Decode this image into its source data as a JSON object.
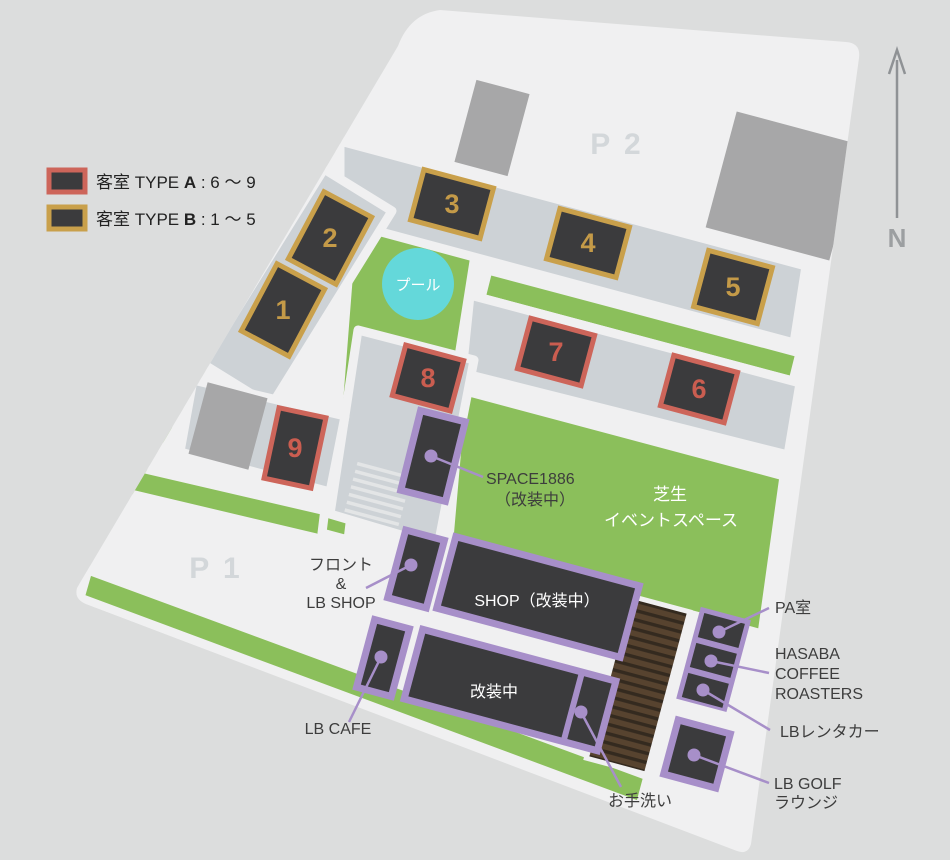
{
  "legend": {
    "items": [
      {
        "prefix": "客室 TYPE ",
        "letter": "A",
        "range": " : 6 ～ 9",
        "color": "#cd655a"
      },
      {
        "prefix": "客室 TYPE ",
        "letter": "B",
        "range": " : 1 ～ 5",
        "color": "#c9a04b"
      }
    ]
  },
  "compass": {
    "label": "N"
  },
  "parking": {
    "p1": "P 1",
    "p2": "P 2"
  },
  "pool": {
    "label": "プール",
    "color": "#64d8da"
  },
  "rooms": [
    {
      "number": "1",
      "type": "B"
    },
    {
      "number": "2",
      "type": "B"
    },
    {
      "number": "3",
      "type": "B"
    },
    {
      "number": "4",
      "type": "B"
    },
    {
      "number": "5",
      "type": "B"
    },
    {
      "number": "6",
      "type": "A"
    },
    {
      "number": "7",
      "type": "A"
    },
    {
      "number": "8",
      "type": "A"
    },
    {
      "number": "9",
      "type": "A"
    }
  ],
  "lawn_event": {
    "line1": "芝生",
    "line2": "イベントスペース"
  },
  "facilities": {
    "space1886": {
      "name": "SPACE1886",
      "note": "（改装中）"
    },
    "front": {
      "line1": "フロント",
      "line2": "&",
      "line3": "LB SHOP"
    },
    "shop": {
      "label": "SHOP（改装中）"
    },
    "cafe": {
      "label": "LB CAFE"
    },
    "renovation": {
      "label": "改装中"
    },
    "restroom": {
      "label": "お手洗い"
    },
    "pa": {
      "label": "PA室"
    },
    "hasaba": {
      "line1": "HASABA",
      "line2": "COFFEE",
      "line3": "ROASTERS"
    },
    "rentacar": {
      "label": "LBレンタカー"
    },
    "golf": {
      "line1": "LB GOLF",
      "line2": "ラウンジ"
    }
  },
  "colors": {
    "background": "#dcdddd",
    "site": "#f0f0f1",
    "road": "#cdd2d6",
    "lawn": "#8bbf5b",
    "building_dark": "#3b3b3d",
    "type_a_red": "#cd655a",
    "type_b_gold": "#c9a04b",
    "facility_purple": "#a78fc9",
    "pool_cyan": "#64d8da",
    "deck_brown": "#57432f"
  }
}
